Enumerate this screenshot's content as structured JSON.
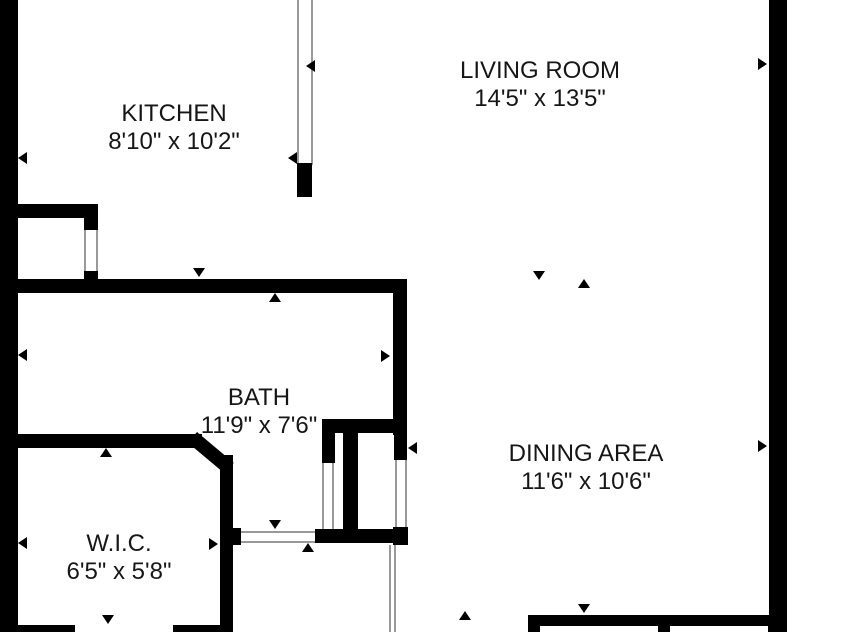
{
  "page": {
    "type": "floor-plan"
  },
  "rooms": {
    "kitchen": {
      "name": "KITCHEN",
      "dimensions": "8'10\" x 10'2\""
    },
    "living_room": {
      "name": "LIVING ROOM",
      "dimensions": "14'5\" x 13'5\""
    },
    "bath": {
      "name": "BATH",
      "dimensions": "11'9\" x 7'6\""
    },
    "dining_area": {
      "name": "DINING AREA",
      "dimensions": "11'6\" x 10'6\""
    },
    "wic": {
      "name": "W.I.C.",
      "dimensions": "6'5\" x 5'8\""
    }
  },
  "colors": {
    "wall": "#000000",
    "background": "#ffffff",
    "text": "#161616",
    "opening_line": "#999999"
  }
}
